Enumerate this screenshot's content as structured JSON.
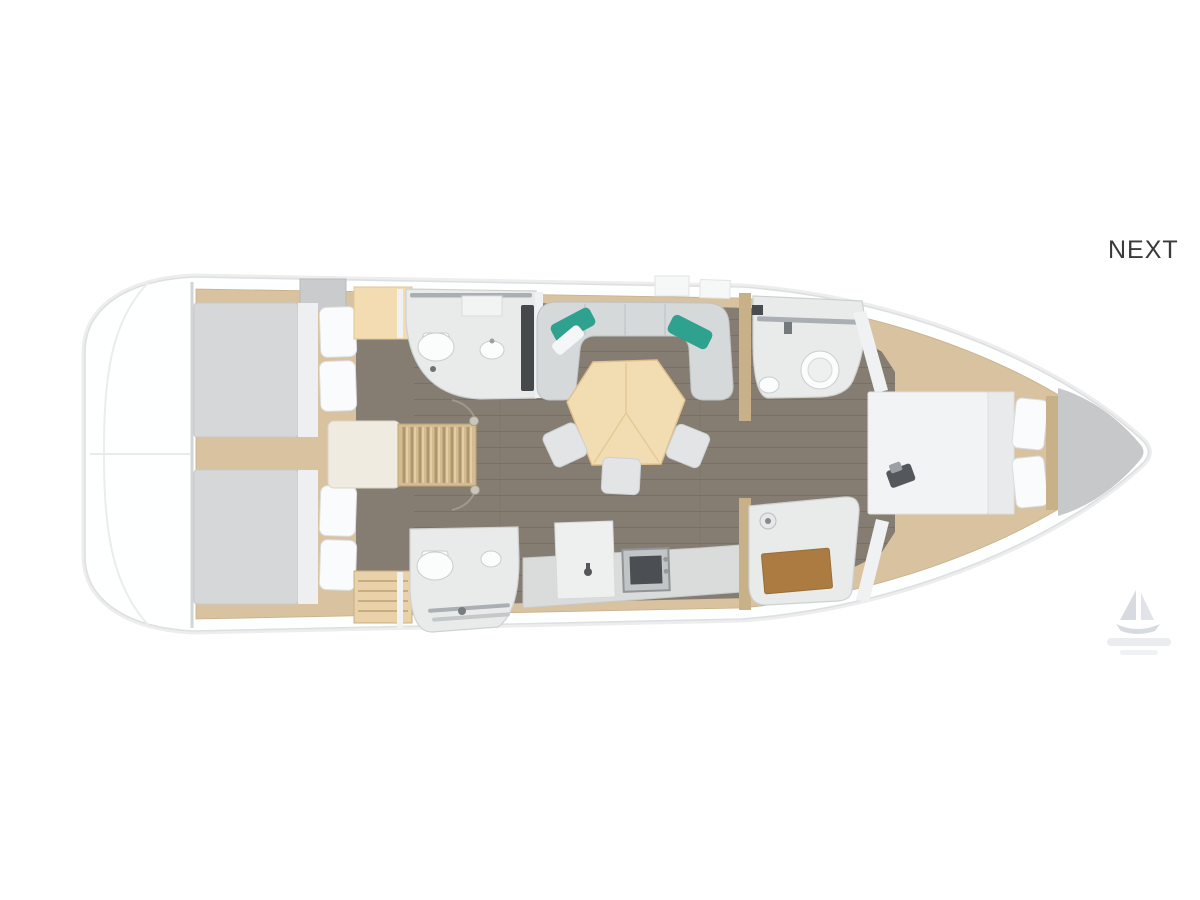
{
  "nav": {
    "next_label": "NEXT"
  },
  "floorplan": {
    "title": "sailing-yacht-deck-plan",
    "orientation": "bow-right",
    "regions": [
      "stern-platform",
      "aft-cabin-port",
      "aft-cabin-starboard",
      "companionway-stairs",
      "head-port-aft",
      "salon-sofa",
      "salon-dining-table",
      "salon-chairs",
      "galley",
      "head-starboard-aft",
      "head-forward",
      "forward-shower",
      "forward-cabin",
      "bow-deck"
    ]
  },
  "watermark": {
    "icon": "sailboat-icon"
  },
  "colors": {
    "page_bg": "#ffffff",
    "hull_fill": "#feffff",
    "hull_stroke": "#dddfe1",
    "hull_shadow": "#ededee",
    "trim_wood": "#d8c29f",
    "trim_wood_dark": "#c8b089",
    "floor_dark": "#867d72",
    "floor_line": "#796f64",
    "bed_gray": "#d5d7d9",
    "bed_white": "#f2f3f4",
    "pillow_white": "#fafbfc",
    "frame_white": "#edeff0",
    "sofa_gray": "#d6d9da",
    "cushion_teal": "#2fa18f",
    "table_beige": "#f2dcb2",
    "chair_gray": "#e2e4e6",
    "bath_panel": "#e9ebeb",
    "fixture_white": "#fbfcfc",
    "chrome": "#a9afb3",
    "dark_equip": "#46494c",
    "mat_brown": "#ab7b41",
    "bow_deck": "#c6c8ca",
    "landing": "#f0ebe1",
    "stairs_wood": "#d3bb92",
    "text_dark": "#3a3a3a",
    "watermark": "#c3c9d1"
  }
}
